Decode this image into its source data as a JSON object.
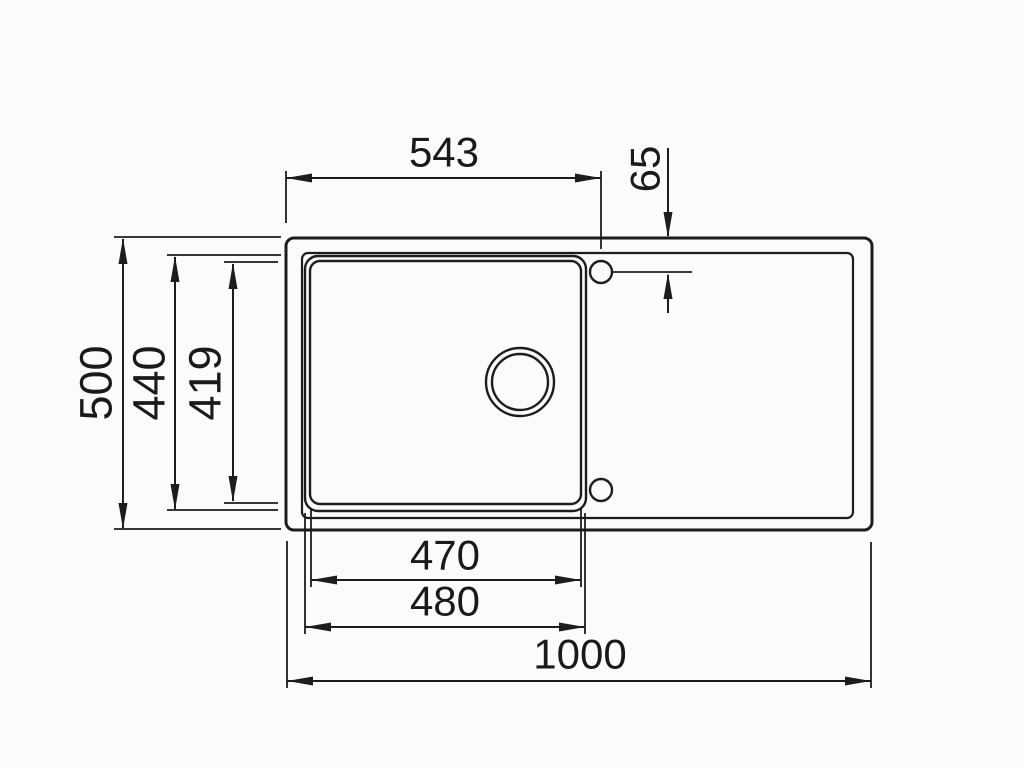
{
  "page": {
    "background": "#fbfbfb",
    "line_color": "#1d1d1d",
    "text_color": "#1a1a1a"
  },
  "drawing": {
    "title": "Inset sink top-view technical drawing",
    "view": "top",
    "features": [
      "outer-rim",
      "inner-rim",
      "bowl-outer-edge",
      "bowl-inner-edge",
      "drain-hole",
      "tap-hole-top",
      "tap-hole-bottom",
      "drainer-area"
    ],
    "dimensions": {
      "overall_width": "1000",
      "overall_depth": "500",
      "bowl_outer_depth": "440",
      "bowl_inner_depth": "419",
      "bowl_inner_width": "470",
      "bowl_outer_width": "480",
      "tap_hole_center_from_left": "543",
      "tap_hole_center_from_top": "65"
    }
  }
}
